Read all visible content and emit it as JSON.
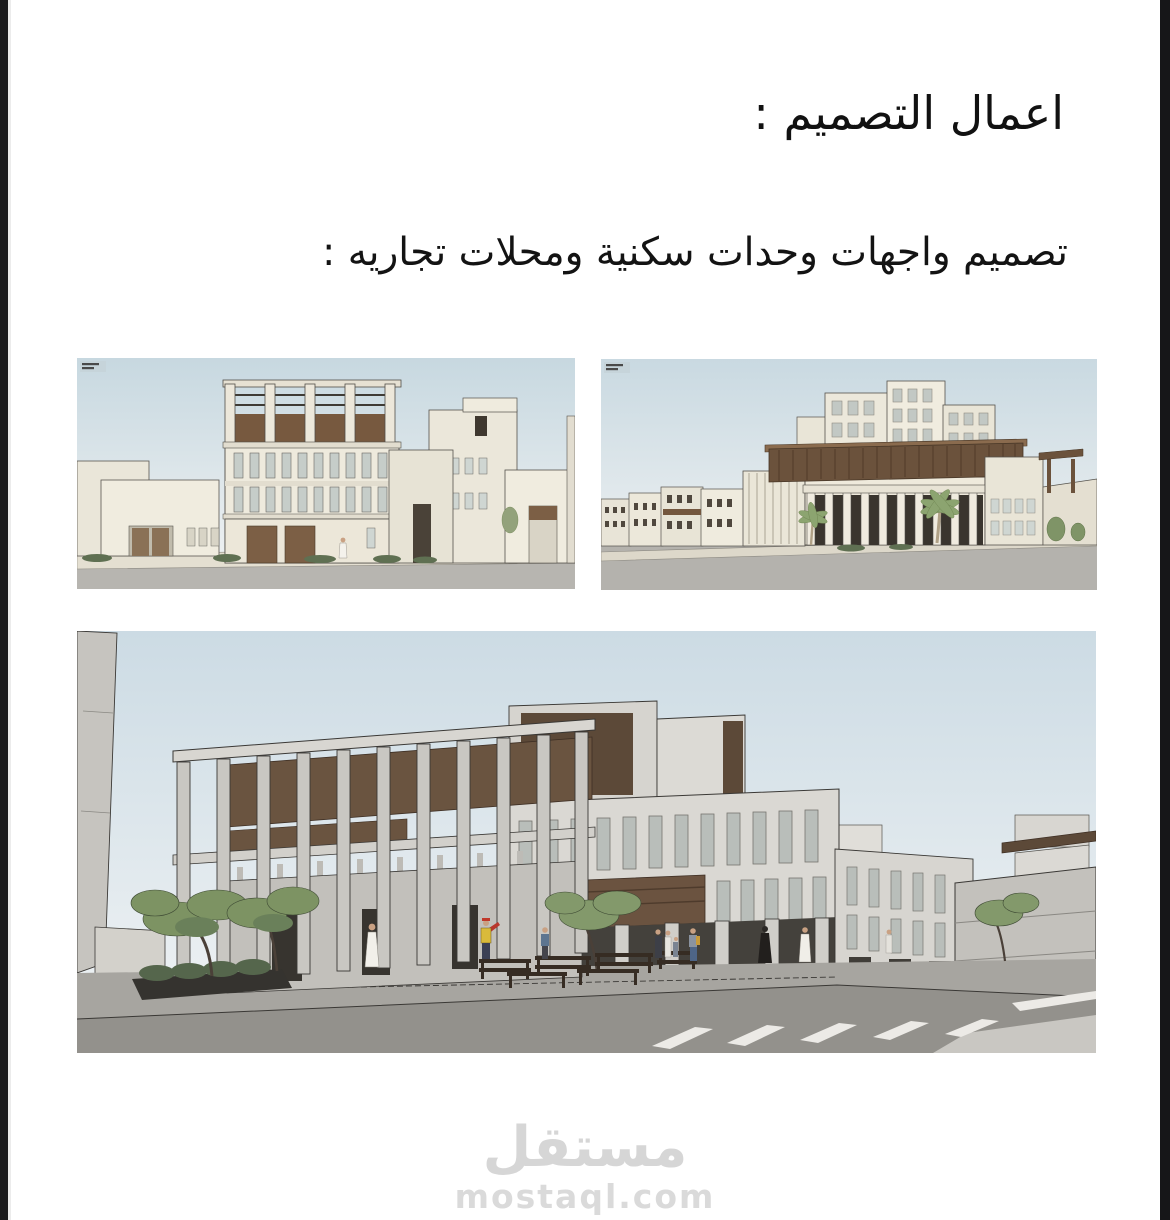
{
  "page": {
    "title": "اعمال التصميم :",
    "subtitle": "تصميم  واجهات وحدات سكنية ومحلات تجاريه :"
  },
  "watermark": {
    "logo": "مستقل",
    "site": "mostaql.com"
  },
  "colors": {
    "sky": "#cbdae2",
    "building_beige": "#eeeadd",
    "building_gray": "#d8d6d1",
    "wood_brown": "#6b523c",
    "road_gray": "#b5b3ae",
    "plaza_gray": "#a7a5a0",
    "tree_green": "#7e9465",
    "watermark_gray": "#d6d6d6",
    "edge_strip_black": "#1b1b1d",
    "text_black": "#111111"
  }
}
